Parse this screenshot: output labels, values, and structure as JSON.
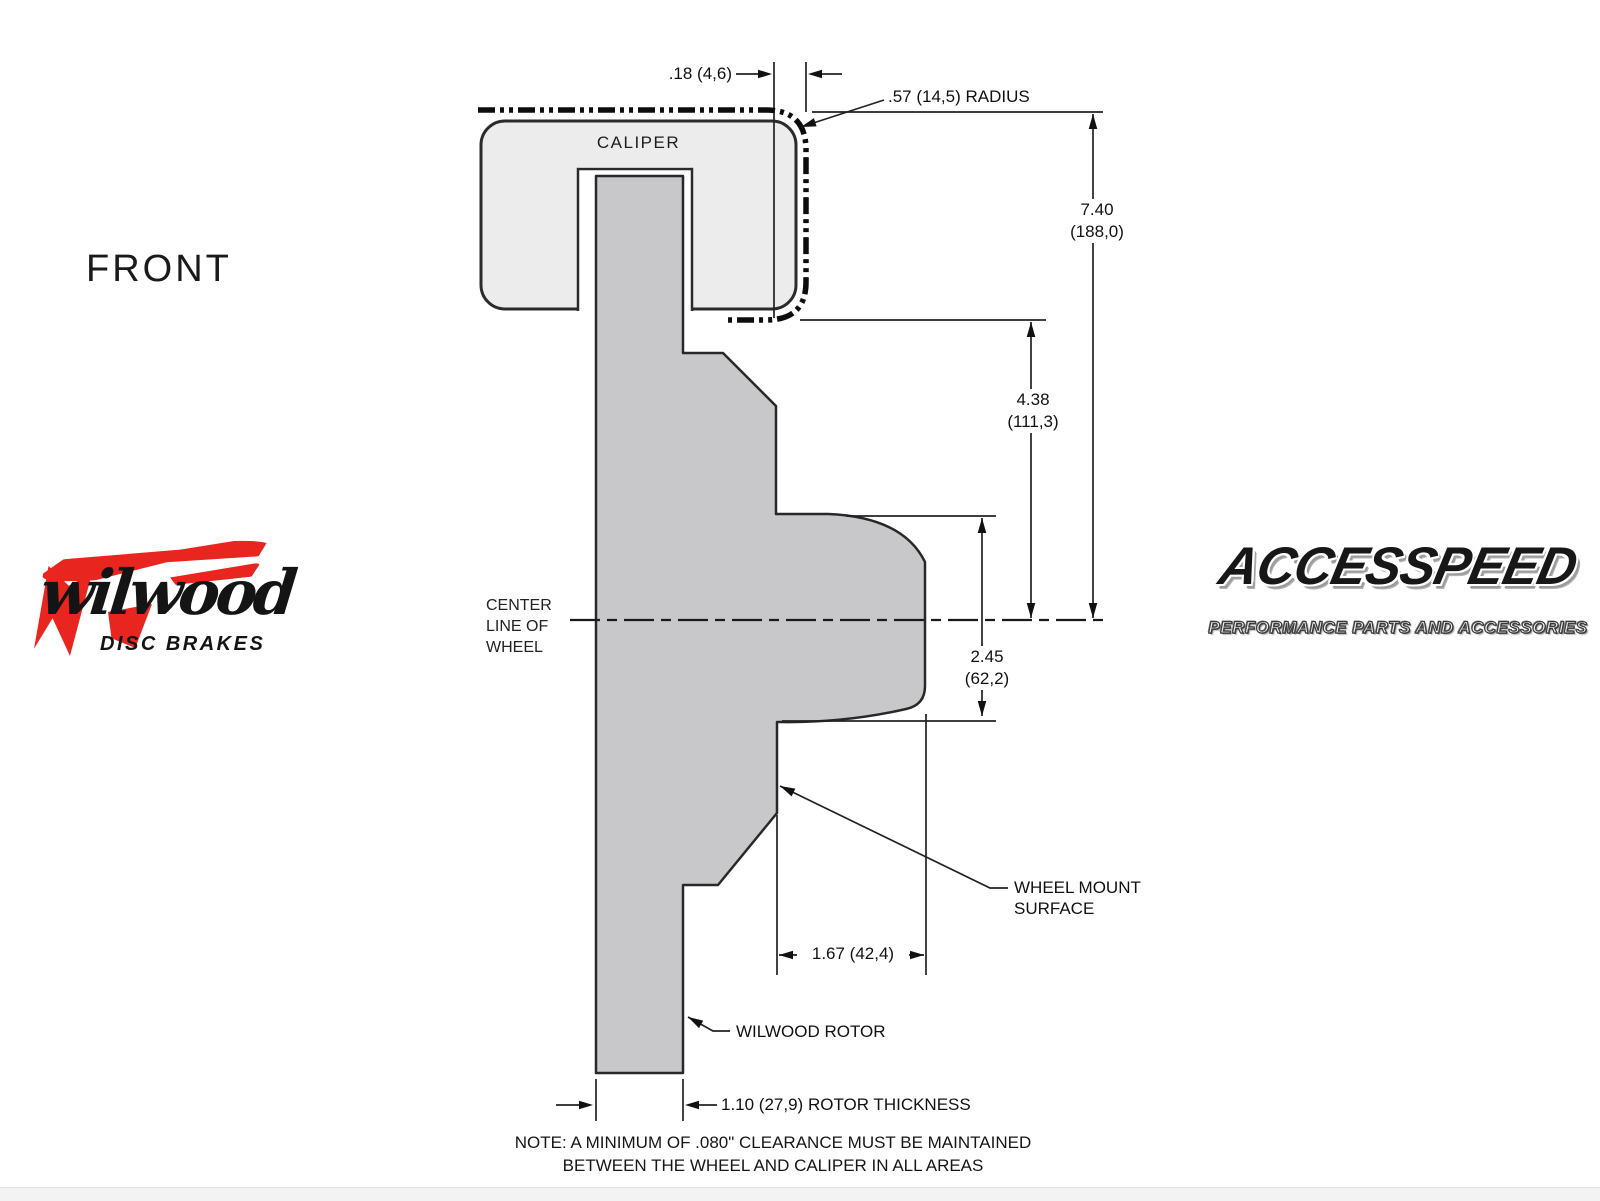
{
  "front_label": "FRONT",
  "drawing": {
    "caliper_label": "CALIPER",
    "centerline_label": "CENTER\nLINE OF\nWHEEL",
    "wheel_mount_label": "WHEEL MOUNT\nSURFACE",
    "rotor_label": "WILWOOD ROTOR",
    "dim_gap": ".18 (4,6)",
    "dim_radius": ".57 (14,5) RADIUS",
    "dim_overall_height": "7.40\n(188,0)",
    "dim_caliper_to_center": "4.38\n(111,3)",
    "dim_hat_depth": "2.45\n(62,2)",
    "dim_mount_offset": "1.67 (42,4)",
    "dim_rotor_thickness": "1.10 (27,9) ROTOR THICKNESS",
    "note": "NOTE: A MINIMUM OF .080\" CLEARANCE MUST BE MAINTAINED\nBETWEEN THE WHEEL AND CALIPER IN ALL AREAS"
  },
  "logos": {
    "wilwood_name": "wilwood",
    "wilwood_tagline": "DISC BRAKES",
    "accesspeed_name": "ACCESSPEED",
    "accesspeed_tagline": "PERFORMANCE PARTS AND ACCESSORIES"
  },
  "colors": {
    "rotor_gray": "#c8c8ca",
    "caliper_gray": "#ececed",
    "line_black": "#1a1a1a",
    "wilwood_red": "#e8261f"
  }
}
